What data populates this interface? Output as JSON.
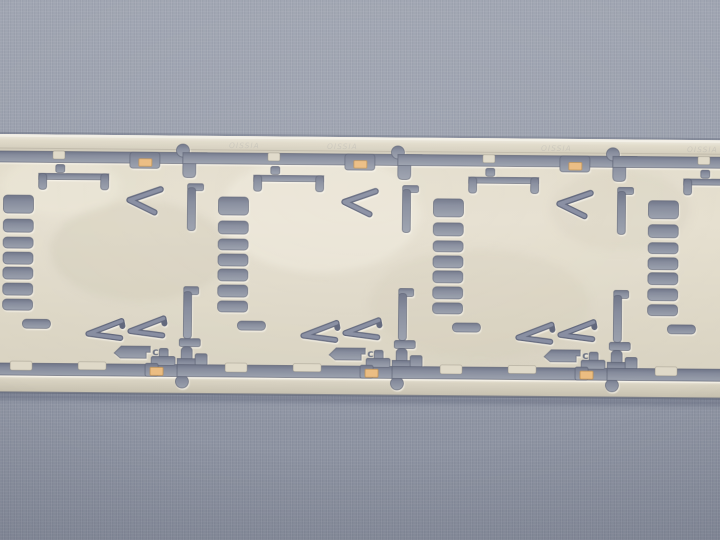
{
  "scene": {
    "description": "Close-up photograph of a photo-etched metal lead-frame strip (champagne / nickel-silver colored) lying horizontally on a blue-gray textured paper background. The strip carries a repeating etched pattern of rectangular cells.",
    "visible_units": 4,
    "tooling_holes_top": 3,
    "tooling_holes_bottom": 3
  },
  "marking": {
    "text": "OISSIA"
  },
  "unit": {
    "cut_letter": "c",
    "ladder_slot_count": 8,
    "arrow_cut_count": 2
  },
  "colors": {
    "background_gray": "#959BA9",
    "cutout_gray": "#848A9B",
    "cutout_shadow": "#6E7487",
    "metal_light": "#E6E0D0",
    "metal_mid": "#DDD7C6",
    "rail_highlight": "#F2EFE6",
    "copper_pad": "#EBBC80",
    "edge_line": "#5F6578"
  }
}
